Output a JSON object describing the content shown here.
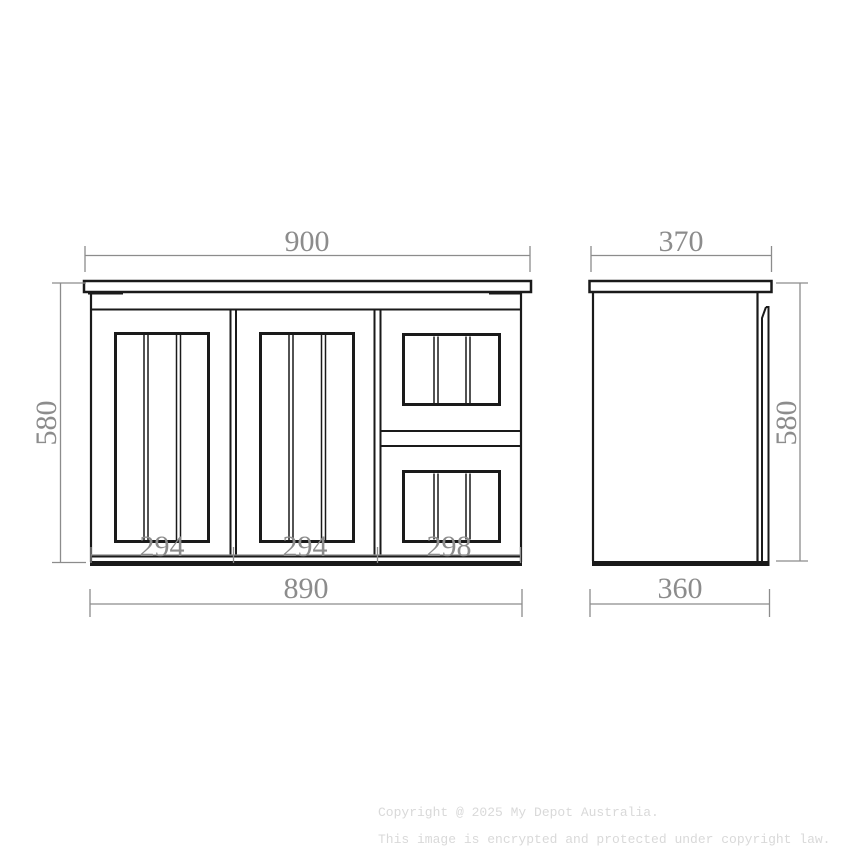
{
  "drawing": {
    "line_color": "#1a1a1a",
    "dimension_color": "#8c8c8c",
    "background": "#ffffff",
    "front_view": {
      "dims": {
        "top_width": "900",
        "height": "580",
        "bottom_width": "890",
        "left_door_width": "294",
        "middle_door_width": "294",
        "drawer_width": "298"
      }
    },
    "side_view": {
      "dims": {
        "top_depth": "370",
        "height": "580",
        "bottom_depth": "360"
      }
    }
  },
  "footer": {
    "color": "#d9d9d9",
    "line1": "Copyright @ 2025 My Depot Australia.",
    "line2": "This image is encrypted and protected under copyright law."
  }
}
